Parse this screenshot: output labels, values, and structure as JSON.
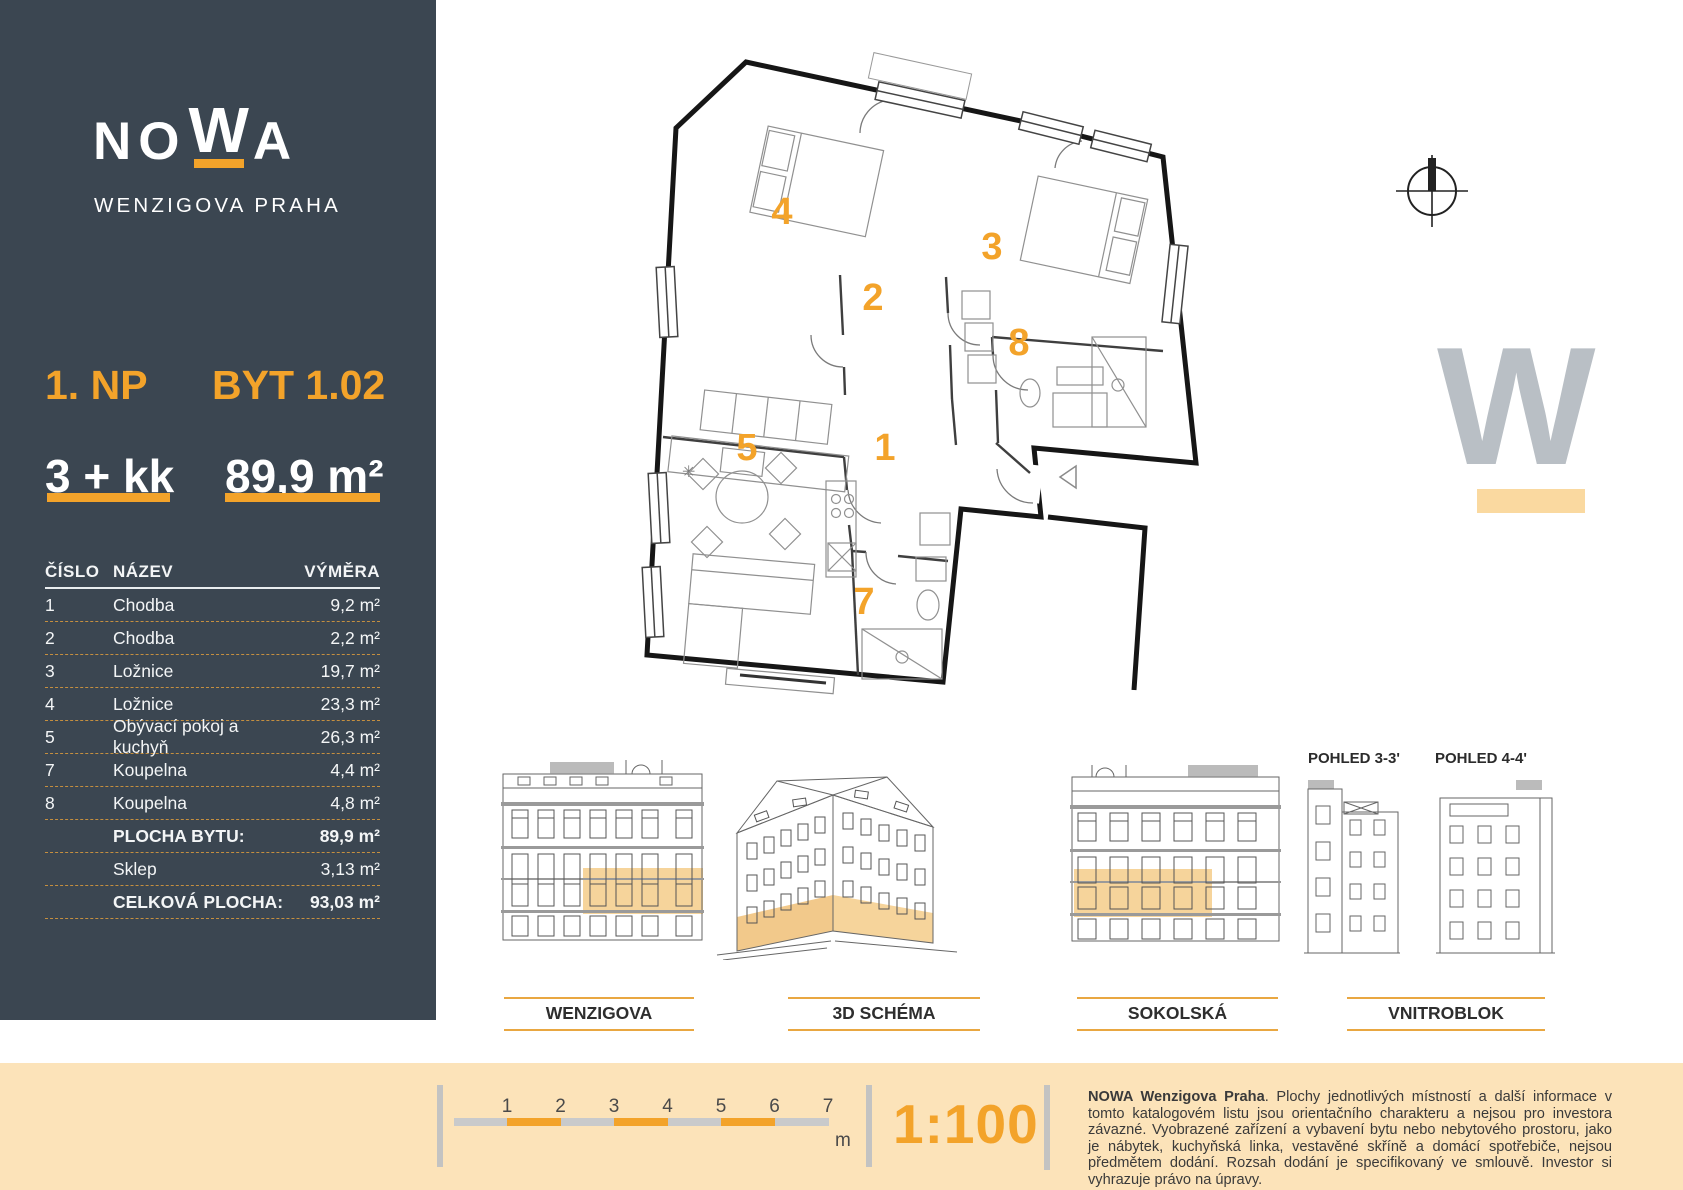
{
  "colors": {
    "accent": "#F3A32A",
    "sidebar_bg": "#3B4651",
    "cream": "#FCE3B9",
    "highlight": "#F6D49B",
    "watermark_gray": "#B9BFC5"
  },
  "sidebar": {
    "logo": {
      "l1": "NO",
      "w": "W",
      "l2": "A",
      "subtitle": "WENZIGOVA PRAHA"
    },
    "floor_label": "1. NP",
    "unit_label": "BYT 1.02",
    "layout": "3 + kk",
    "area": "89,9 m²",
    "table": {
      "headers": [
        "ČÍSLO",
        "NÁZEV",
        "VÝMĚRA"
      ],
      "rows": [
        {
          "num": "1",
          "name": "Chodba",
          "area": "9,2 m²",
          "bold": false
        },
        {
          "num": "2",
          "name": "Chodba",
          "area": "2,2 m²",
          "bold": false
        },
        {
          "num": "3",
          "name": "Ložnice",
          "area": "19,7 m²",
          "bold": false
        },
        {
          "num": "4",
          "name": "Ložnice",
          "area": "23,3 m²",
          "bold": false
        },
        {
          "num": "5",
          "name": "Obývací pokoj a kuchyň",
          "area": "26,3 m²",
          "bold": false
        },
        {
          "num": "7",
          "name": "Koupelna",
          "area": "4,4 m²",
          "bold": false
        },
        {
          "num": "8",
          "name": "Koupelna",
          "area": "4,8 m²",
          "bold": false
        },
        {
          "num": "",
          "name": "PLOCHA BYTU:",
          "area": "89,9 m²",
          "bold": true
        },
        {
          "num": "",
          "name": "Sklep",
          "area": "3,13 m²",
          "bold": false
        },
        {
          "num": "",
          "name": "CELKOVÁ PLOCHA:",
          "area": "93,03 m²",
          "bold": true
        }
      ]
    }
  },
  "plan": {
    "watermark": "W",
    "rooms": [
      {
        "n": "1",
        "x": 255,
        "y": 403
      },
      {
        "n": "2",
        "x": 243,
        "y": 253
      },
      {
        "n": "3",
        "x": 362,
        "y": 202
      },
      {
        "n": "4",
        "x": 152,
        "y": 167
      },
      {
        "n": "5",
        "x": 117,
        "y": 403
      },
      {
        "n": "7",
        "x": 234,
        "y": 557
      },
      {
        "n": "8",
        "x": 389,
        "y": 298
      }
    ]
  },
  "elevations": {
    "labels": [
      "WENZIGOVA",
      "3D SCHÉMA",
      "SOKOLSKÁ",
      "VNITROBLOK"
    ],
    "pohled_left": "POHLED 3-3'",
    "pohled_right": "POHLED 4-4'"
  },
  "footer": {
    "scale_numbers": [
      "1",
      "2",
      "3",
      "4",
      "5",
      "6",
      "7"
    ],
    "unit": "m",
    "scale_text": "1:100",
    "disclaimer_bold": "NOWA Wenzigova Praha",
    "disclaimer_rest": ". Plochy jednotlivých místností a další informace v tomto katalogovém listu jsou orientačního charakteru a nejsou pro investora závazné. Vyobrazené zařízení a vybavení bytu nebo nebytového prostoru, jako je nábytek, kuchyňská linka, vestavěné skříně a domácí spotřebiče, nejsou předmětem dodání. Rozsah dodání je specifikovaný ve smlouvě. Investor si vyhrazuje právo na úpravy."
  }
}
